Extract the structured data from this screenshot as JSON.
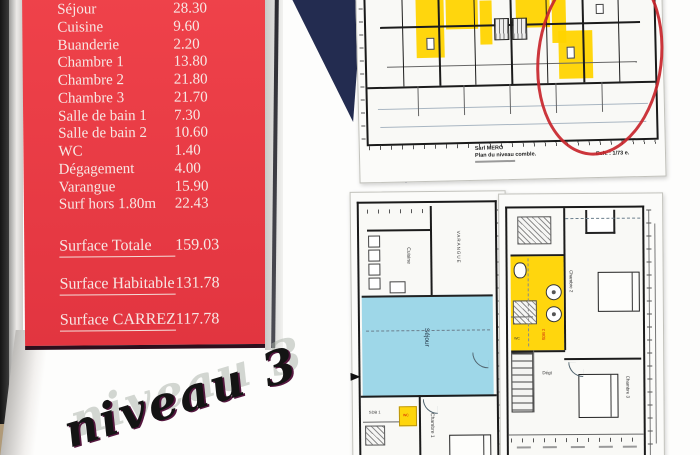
{
  "surface_panel": {
    "rows": [
      {
        "label": "Séjour",
        "value": "28.30"
      },
      {
        "label": "Cuisine",
        "value": "9.60"
      },
      {
        "label": "Buanderie",
        "value": "2.20"
      },
      {
        "label": "Chambre 1",
        "value": "13.80"
      },
      {
        "label": "Chambre 2",
        "value": "21.80"
      },
      {
        "label": "Chambre 3",
        "value": "21.70"
      },
      {
        "label": "Salle de bain 1",
        "value": "7.30"
      },
      {
        "label": "Salle de bain 2",
        "value": "10.60"
      },
      {
        "label": "WC",
        "value": "1.40"
      },
      {
        "label": "Dégagement",
        "value": "4.00"
      },
      {
        "label": "Varangue",
        "value": "15.90"
      },
      {
        "label": "Surf hors 1.80m",
        "value": "22.43"
      }
    ],
    "totals": [
      {
        "label": "Surface Totale",
        "value": "159.03"
      },
      {
        "label": "Surface Habitable",
        "value": "131.78"
      },
      {
        "label": "Surface CARREZ",
        "value": "117.78"
      }
    ]
  },
  "handwriting": {
    "text": "niveau 3"
  },
  "top_plan": {
    "firm": "Sarl MERO",
    "caption": "Plan du niveau comble.",
    "scale_note": "Ech. : 1/73 e."
  },
  "plan_left": {
    "rooms": {
      "cuisine": "Cuisine",
      "varangue": "VARANGUE",
      "sejour": "Séjour",
      "chambre1": "Chambre 1",
      "sdb1": "SDB 1",
      "wc": "WC"
    }
  },
  "plan_right": {
    "rooms": {
      "sdb2": "SDB 2",
      "chambre2": "Chambre 2",
      "chambre3": "Chambre 3",
      "degt": "Dégt",
      "wc2": "WC"
    }
  },
  "colors": {
    "panel_red": "#e6383f",
    "navy": "#232c50",
    "highlight_yellow": "#ffd400",
    "sejour_cyan": "#9ed7e8",
    "annotation_red": "#c8252b"
  }
}
